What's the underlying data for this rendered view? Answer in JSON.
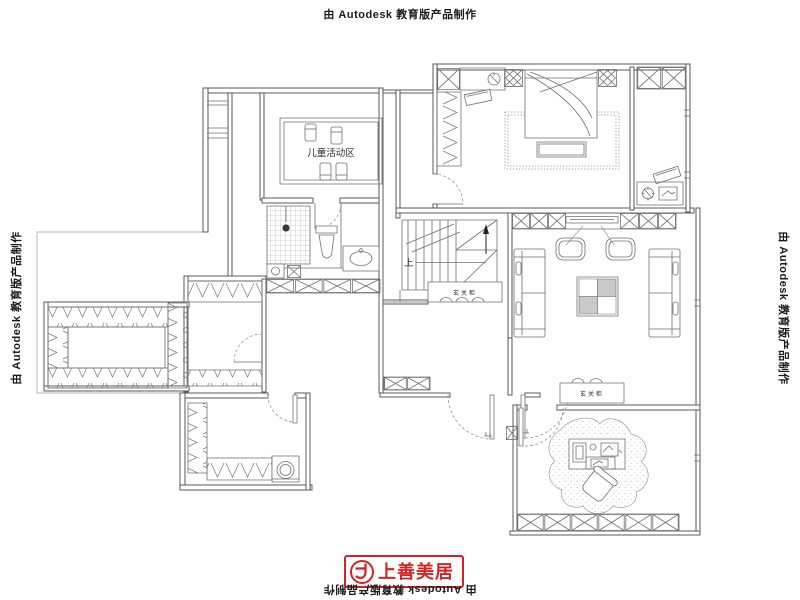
{
  "watermarks": {
    "top": "由 Autodesk 教育版产品制作",
    "left": "由 Autodesk 教育版产品制作",
    "right": "由 Autodesk 教育版产品制作",
    "bottom": "由 Autodesk 教育版产品制作"
  },
  "branding": {
    "logo_text": "上善美居",
    "logo_color": "#d42322"
  },
  "floorplan": {
    "labels": {
      "kids_activity_area": "儿童活动区",
      "stairs_up": "上",
      "entry_cabinet_stairs": "玄关柜",
      "entry_cabinet_hall": "玄关柜"
    }
  }
}
